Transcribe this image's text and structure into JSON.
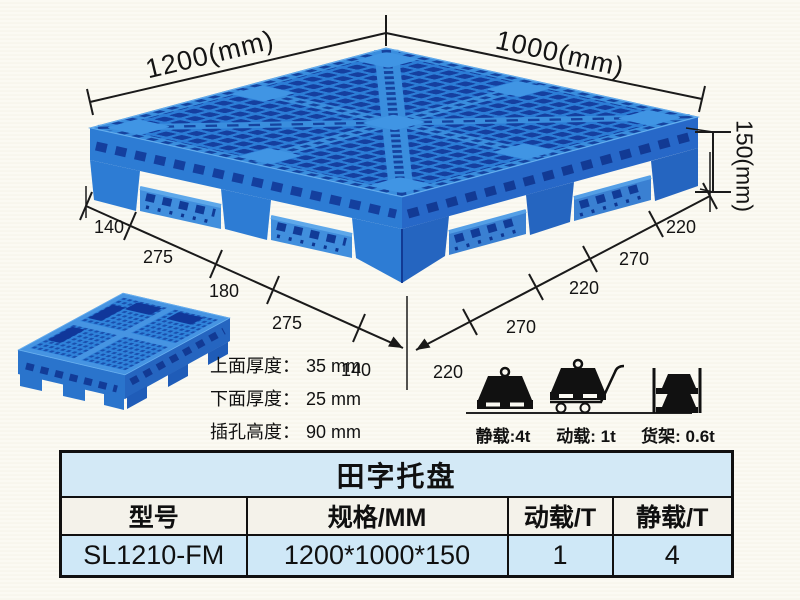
{
  "product_view": {
    "top_width_label": "1200(mm)",
    "top_depth_label": "1000(mm)",
    "height_label": "150(mm)",
    "left_edge_dims": [
      "140",
      "275",
      "180",
      "275",
      "140"
    ],
    "right_edge_dims": [
      "220",
      "270",
      "220",
      "270",
      "220"
    ],
    "notes": [
      {
        "label": "上面厚度：",
        "value": "35 mm"
      },
      {
        "label": "下面厚度：",
        "value": "25 mm"
      },
      {
        "label": "插孔高度：",
        "value": "90 mm"
      }
    ]
  },
  "load_ratings": [
    {
      "icon": "static-load-icon",
      "label": "静载:4t"
    },
    {
      "icon": "dynamic-load-icon",
      "label": "动载: 1t"
    },
    {
      "icon": "rack-load-icon",
      "label": "货架: 0.6t"
    }
  ],
  "spec_table": {
    "title": "田字托盘",
    "headers": [
      "型号",
      "规格/MM",
      "动载/T",
      "静载/T"
    ],
    "rows": [
      [
        "SL1210-FM",
        "1200*1000*150",
        "1",
        "4"
      ]
    ]
  },
  "colors": {
    "pallet_blue": "#2c7dd6",
    "pallet_hole_blue": "#153f9f",
    "annotation_black": "#1a1a1a",
    "table_title_bg": "#d3e9f6",
    "table_row_bg": "#cfe8f7"
  }
}
